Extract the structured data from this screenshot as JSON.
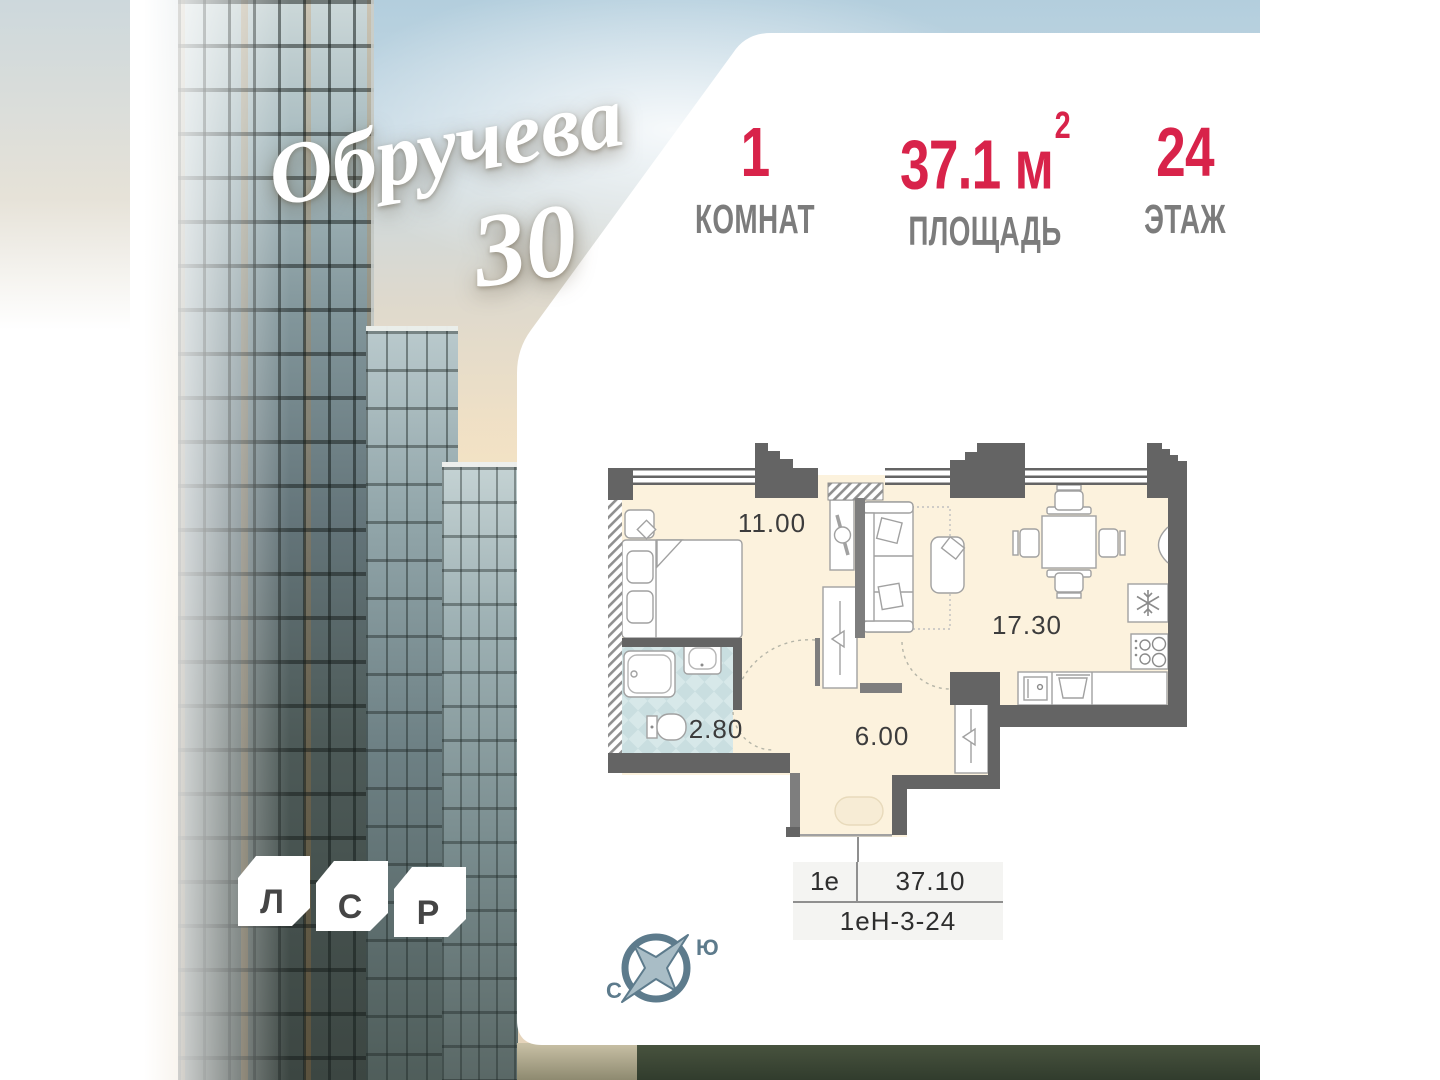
{
  "branding": {
    "residence_name": "Обручева",
    "residence_number": "30",
    "developer_letters": [
      "Л",
      "С",
      "Р"
    ]
  },
  "header": {
    "stats": [
      {
        "value": "1",
        "label": "КОМНАТ"
      },
      {
        "value": "37.1",
        "unit": "м",
        "unit_sup": "2",
        "label": "ПЛОЩАДЬ"
      },
      {
        "value": "24",
        "label": "ЭТАЖ"
      }
    ]
  },
  "floor_plan": {
    "room_labels": [
      {
        "room": "bedroom",
        "area": "11.00"
      },
      {
        "room": "living-kitchen",
        "area": "17.30"
      },
      {
        "room": "bathroom",
        "area": "2.80"
      },
      {
        "room": "hallway",
        "area": "6.00"
      }
    ]
  },
  "spec_table": {
    "layout_type": "1е",
    "total_area": "37.10",
    "unit_code": "1еН-3-24"
  },
  "compass": {
    "south_label": "Ю",
    "north_label": "С"
  },
  "colors": {
    "accent_red": "#d8234a",
    "label_gray": "#7c7c7c",
    "wall_dark": "#646464",
    "wall_medium": "#7e7e7e",
    "room_cream": "#fcf2dd",
    "bathroom_blue": "#d7e8e9",
    "compass_slate": "#5d7b8c"
  }
}
